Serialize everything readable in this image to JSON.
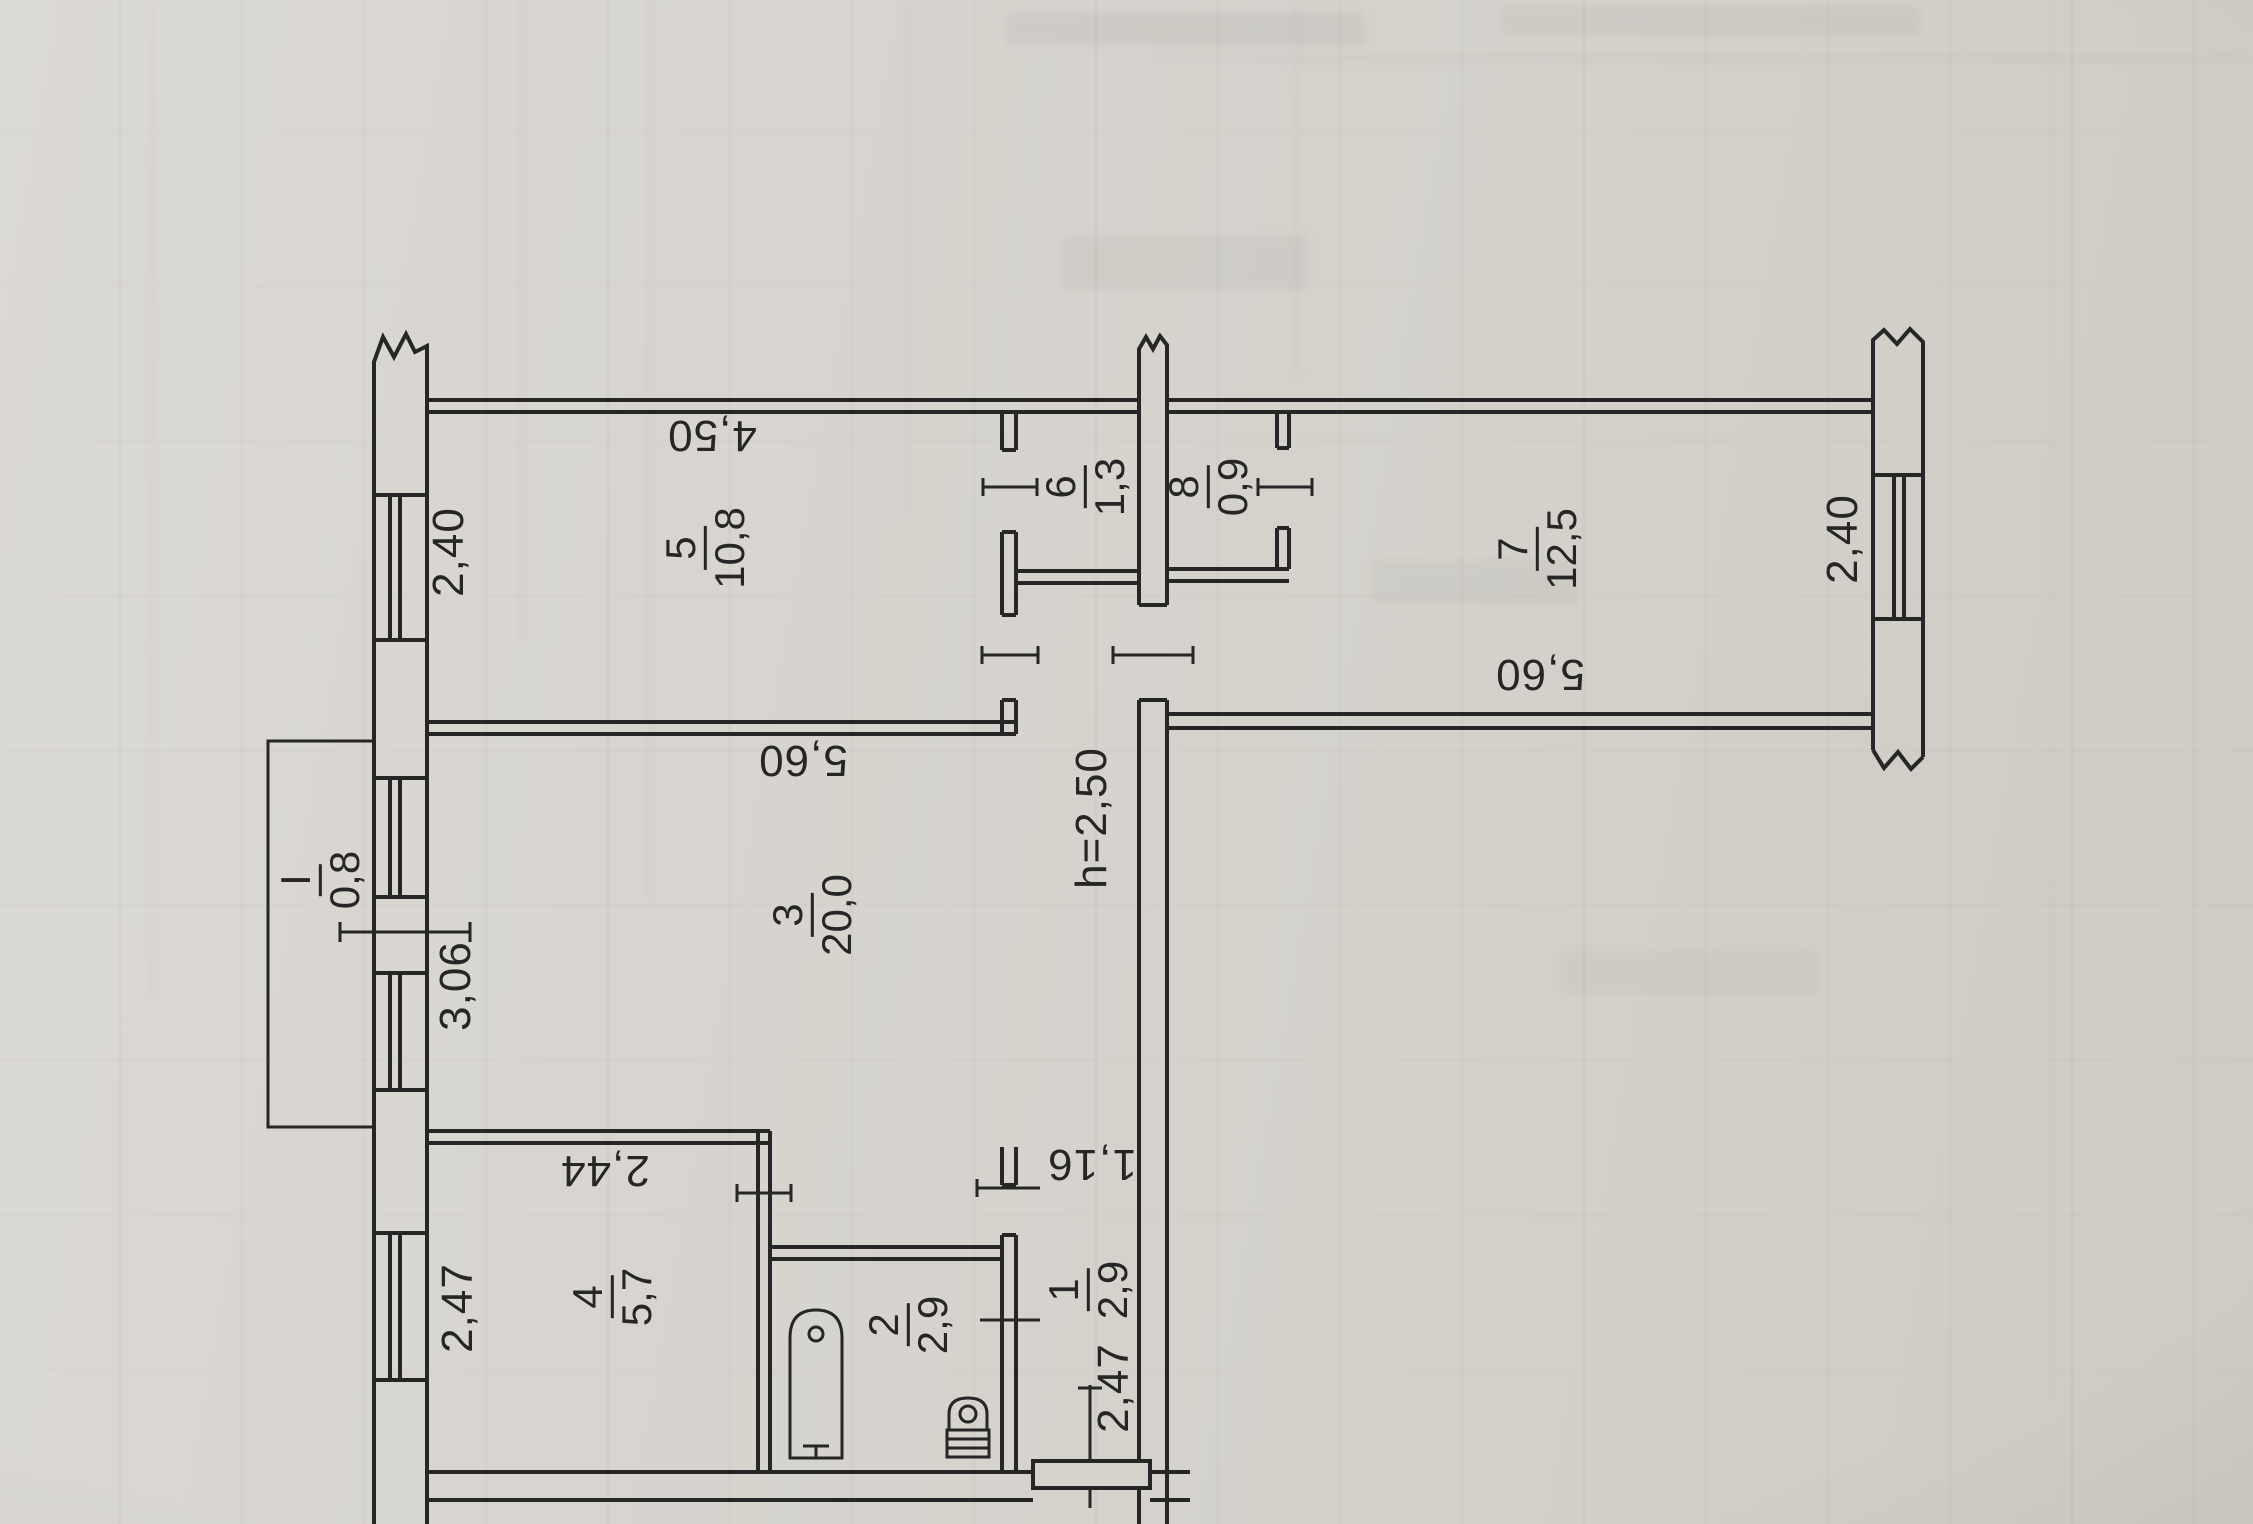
{
  "document": {
    "ceiling_height": "h=2,50"
  },
  "colors": {
    "paper": "#d6d3cd",
    "ink": "#262626"
  },
  "rooms": [
    {
      "number": "5",
      "area": "10,8"
    },
    {
      "number": "6",
      "area": "1,3"
    },
    {
      "number": "8",
      "area": "0,9"
    },
    {
      "number": "7",
      "area": "12,5"
    },
    {
      "number": "3",
      "area": "20,0"
    },
    {
      "number": "4",
      "area": "5,7"
    },
    {
      "number": "2",
      "area": "2,9"
    },
    {
      "number": "1",
      "area": "2,9"
    },
    {
      "number": "I",
      "area": "0,8"
    }
  ],
  "dimensions": {
    "room5_width": "4,50",
    "room5_depth": "2,40",
    "room7_width": "5,60",
    "room7_depth": "2,40",
    "room3_width": "5,60",
    "balcony_length": "3,06",
    "kitchen_width": "2,44",
    "kitchen_depth": "2,47",
    "hall_width": "1,16",
    "hall_depth": "2,47"
  }
}
